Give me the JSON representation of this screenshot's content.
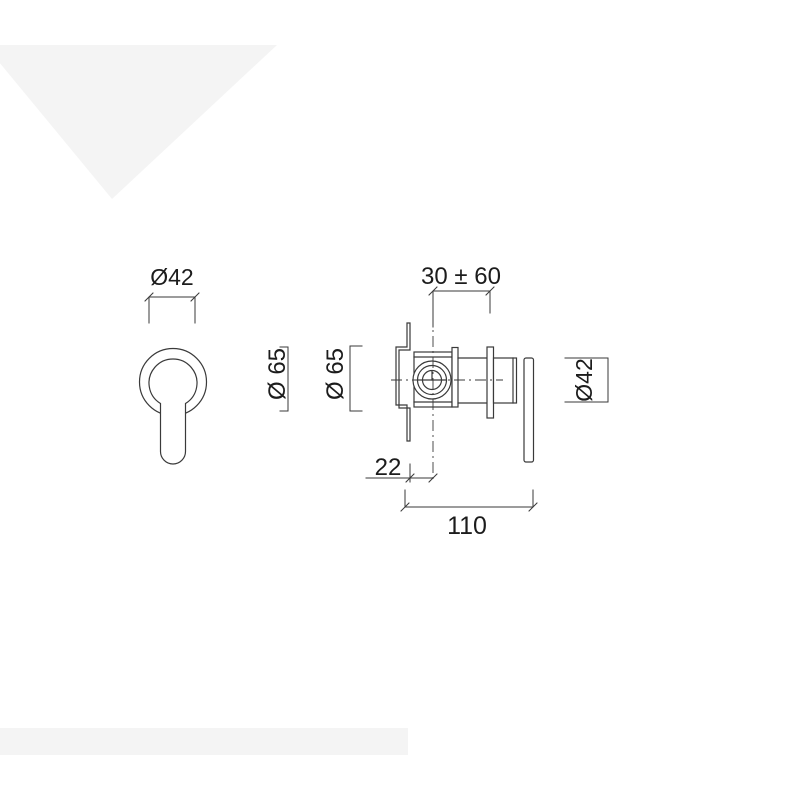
{
  "canvas": {
    "width": 800,
    "height": 800,
    "background": "#ffffff"
  },
  "colors": {
    "line": "#3a3a3a",
    "text": "#1c1c1c",
    "watermark": "#f4f4f4",
    "fill": "#ffffff"
  },
  "drawing": {
    "kind": "technical-dimension-drawing",
    "views": [
      "front",
      "side"
    ]
  },
  "labels": {
    "front_handle_diameter": "Ø42",
    "front_plate_diameter": "Ø 65",
    "side_plate_diameter": "Ø 65",
    "depth_range": "30 ± 60",
    "plate_offset": "22",
    "overall_length": "110",
    "side_trim_diameter": "Ø42"
  }
}
